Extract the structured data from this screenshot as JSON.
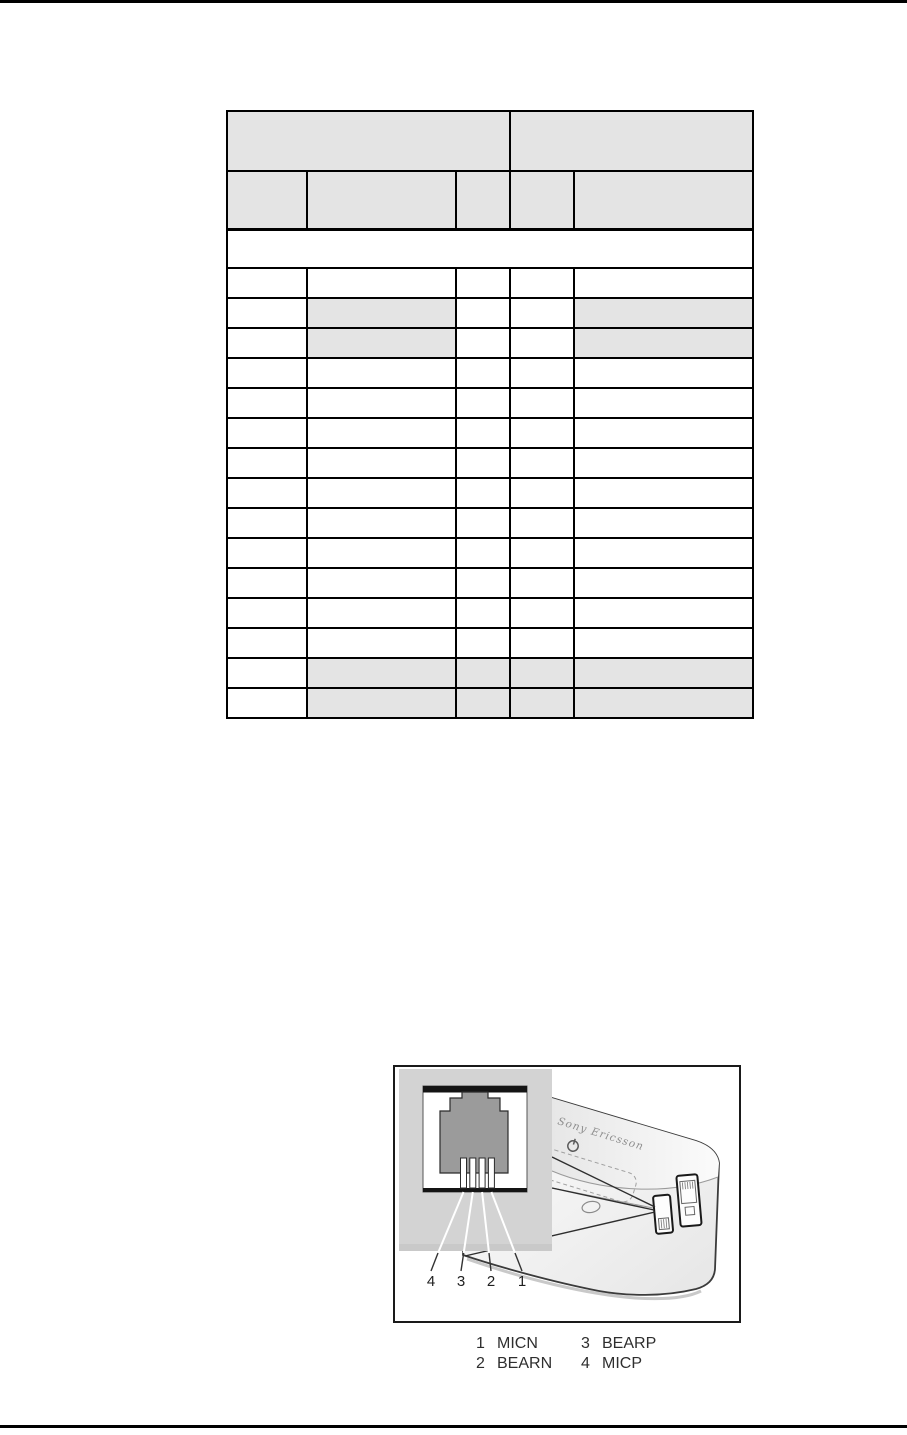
{
  "page": {
    "width_px": 907,
    "height_px": 1435,
    "background": "#ffffff"
  },
  "table": {
    "description": "pin assignment table, all cells blank",
    "shade_color": "#e4e4e4",
    "column_widths_px": [
      80,
      149,
      54,
      64,
      179
    ],
    "header_group_row": {
      "height_px": 60,
      "cells": [
        {
          "colspan": 3
        },
        {
          "colspan": 2
        }
      ]
    },
    "column_header_row": {
      "height_px": 58,
      "cell_count": 5
    },
    "section_band_row": {
      "height_px": 39
    },
    "data_rows": {
      "height_px": 30,
      "count": 15,
      "shaded_columns_by_row": [
        [],
        [
          1,
          4
        ],
        [
          1,
          4
        ],
        [],
        [],
        [],
        [],
        [],
        [],
        [],
        [],
        [],
        [],
        [
          1,
          2,
          3,
          4
        ],
        [
          1,
          2,
          3,
          4
        ]
      ]
    }
  },
  "figure": {
    "device_brand": "Sony Ericsson",
    "connector_pin_numbers": [
      "4",
      "3",
      "2",
      "1"
    ],
    "caption_pins": [
      {
        "pin": "1",
        "label": "MICN"
      },
      {
        "pin": "3",
        "label": "BEARP"
      },
      {
        "pin": "2",
        "label": "BEARN"
      },
      {
        "pin": "4",
        "label": "MICP"
      }
    ]
  }
}
